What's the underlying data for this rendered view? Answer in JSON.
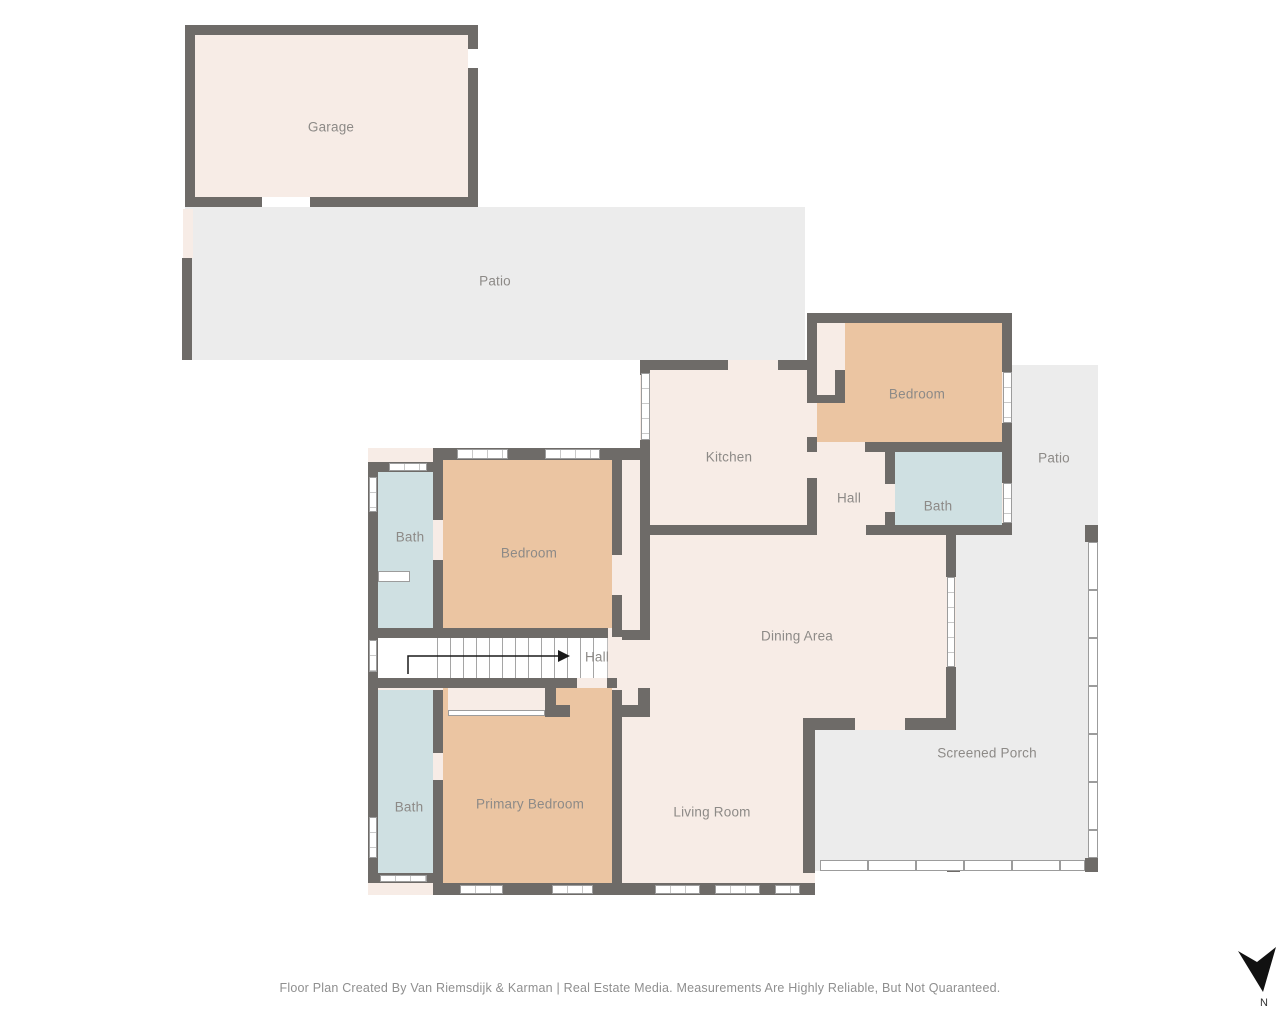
{
  "plan": {
    "rooms": {
      "garage": {
        "label": "Garage"
      },
      "patio_nw": {
        "label": "Patio"
      },
      "kitchen": {
        "label": "Kitchen"
      },
      "bedroom_ne": {
        "label": "Bedroom"
      },
      "hall_upper": {
        "label": "Hall"
      },
      "bath_ne": {
        "label": "Bath"
      },
      "patio_e": {
        "label": "Patio"
      },
      "bedroom_w": {
        "label": "Bedroom"
      },
      "bath_w": {
        "label": "Bath"
      },
      "dining": {
        "label": "Dining Area"
      },
      "hall_stairs": {
        "label": "Hall"
      },
      "primary_bedroom": {
        "label": "Primary Bedroom"
      },
      "bath_sw": {
        "label": "Bath"
      },
      "living": {
        "label": "Living Room"
      },
      "screened_porch": {
        "label": "Screened Porch"
      }
    }
  },
  "compass": {
    "north_label": "N"
  },
  "footer": {
    "credit": "Floor Plan Created By Van Riemsdijk & Karman | Real Estate Media. Measurements Are Highly Reliable, But Not Quaranteed."
  },
  "colors": {
    "wall": "#6e6b68",
    "room_cream": "#f7ece6",
    "room_tan": "#ebc5a2",
    "room_blue": "#cfe0e2",
    "outdoor_gray": "#ececec",
    "label_text": "#8d8a87"
  }
}
